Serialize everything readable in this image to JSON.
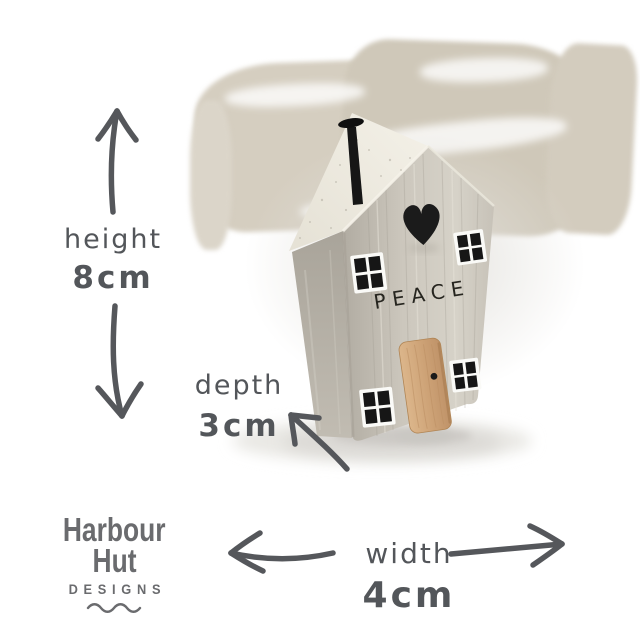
{
  "house": {
    "engraving": "PEACE"
  },
  "annotations": {
    "height": {
      "label": "height",
      "value": "8cm"
    },
    "depth": {
      "label": "depth",
      "value": "3cm"
    },
    "width": {
      "label": "width",
      "value": "4cm"
    }
  },
  "brand": {
    "line1": "Harbour",
    "line2": "Hut",
    "line3": "DESIGNS"
  },
  "colors": {
    "annotation_text": "#53565a",
    "arrow": "#55575b",
    "logo": "#6a6b6e",
    "house_front": "#c9c4ba",
    "house_side": "#b3aea4",
    "roof": "#efebe1",
    "door_wood": "#d2a97f",
    "black_accents": "#1a1a1a",
    "brush_stroke": "#d1cabc"
  }
}
